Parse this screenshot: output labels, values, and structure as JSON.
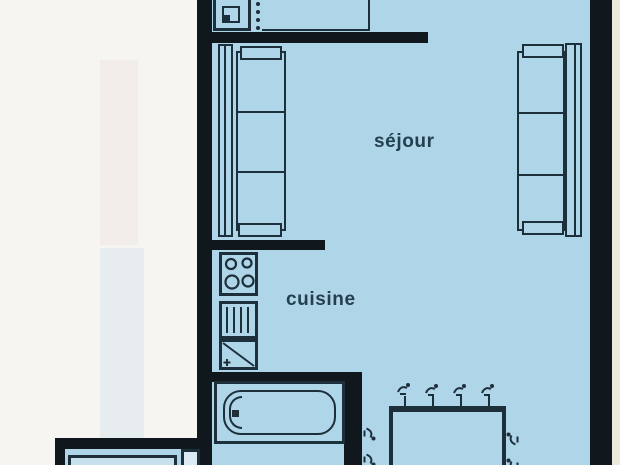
{
  "document": {
    "kind": "apartment floor plan (scanned drawing)"
  },
  "labels": {
    "sejour": "séjour",
    "cuisine": "cuisine"
  },
  "furniture_icons": {
    "left_sofa": "sofa-3-seat-icon",
    "right_sofa": "sofa-3-seat-icon",
    "cooktop": "cooktop-4-burner-icon",
    "sink_unit": "sink-drainer-icon",
    "fridge_unit": "fridge-diagonal-icon",
    "bathtub": "bathtub-icon",
    "dining_table": "dining-table-icon",
    "chair": "chair-icon",
    "entry_unit": "washbasin-unit-icon",
    "cropped_furniture": "cabinet-icon"
  },
  "colors": {
    "interior": "#afd5e8",
    "interior_bright": "#c6e0ee",
    "wall": "#10181d",
    "line": "#1c2f3b",
    "exterior_left": "#f6f5f2",
    "exterior_right": "#ebe8dc",
    "text": "#24404f"
  }
}
